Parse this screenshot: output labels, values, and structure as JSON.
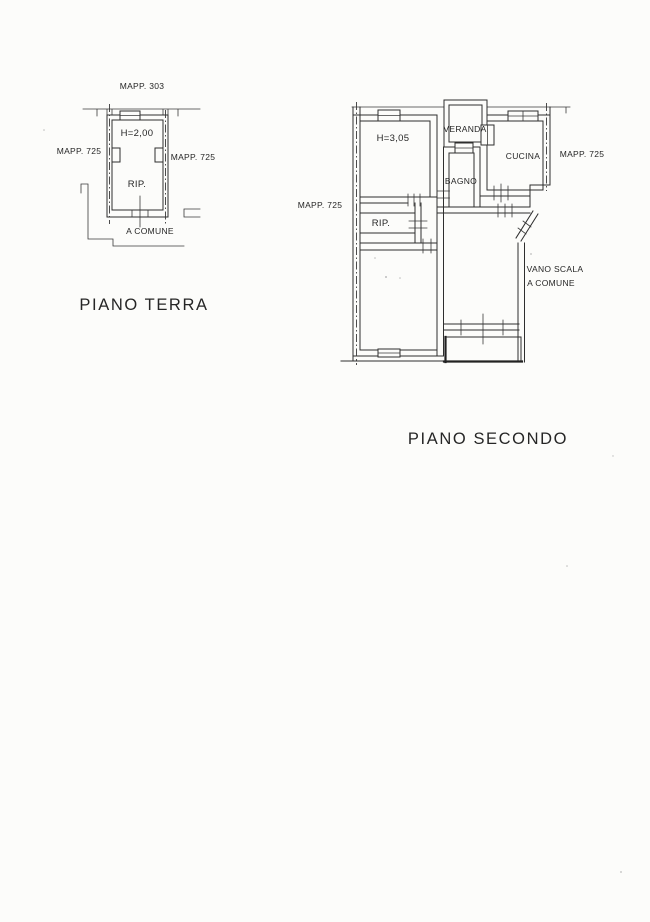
{
  "page": {
    "background": "#fcfcfa",
    "ink_color": "#2e2e2e"
  },
  "ground_floor": {
    "title": "PIANO TERRA",
    "labels": {
      "mapp_top": "MAPP. 303",
      "mapp_left": "MAPP. 725",
      "mapp_right": "MAPP. 725",
      "height": "H=2,00",
      "storage": "RIP.",
      "shared": "A COMUNE"
    }
  },
  "second_floor": {
    "title": "PIANO SECONDO",
    "labels": {
      "mapp_left": "MAPP. 725",
      "mapp_right": "MAPP. 725",
      "height": "H=3,05",
      "veranda": "VERANDA",
      "kitchen": "CUCINA",
      "bathroom": "BAGNO",
      "storage": "RIP.",
      "stairwell_line1": "VANO SCALA",
      "stairwell_line2": "A COMUNE"
    }
  }
}
